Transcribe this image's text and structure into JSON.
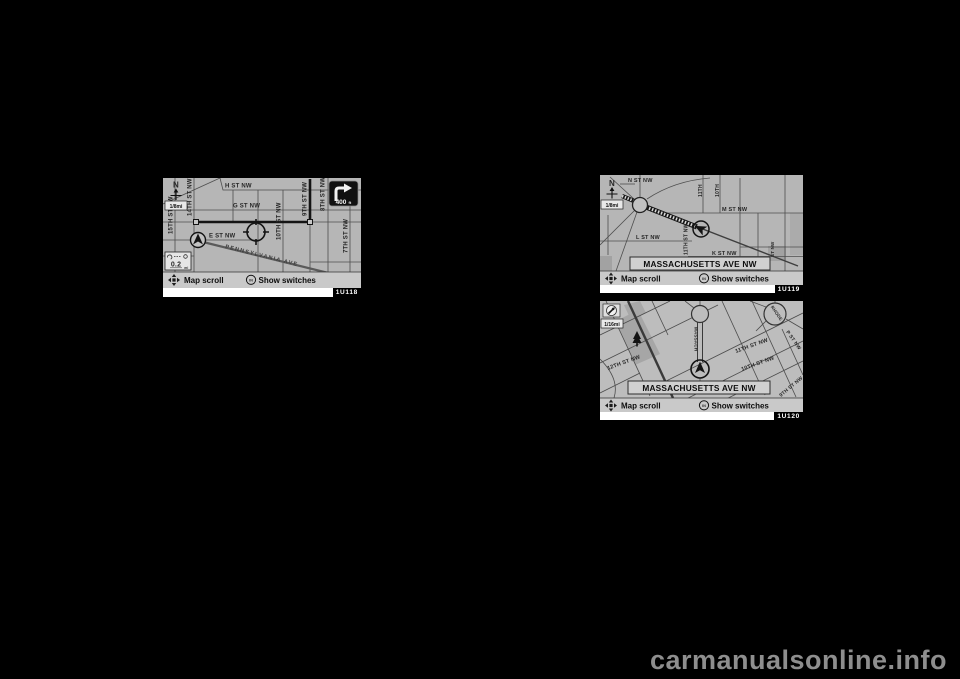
{
  "watermark": "carmanualsonline.info",
  "map1": {
    "figure_id": "1U118",
    "compass_n": "N",
    "scale_badge": "1/8mi",
    "turn": {
      "distance": "400",
      "unit": "ft"
    },
    "zoom_scale": {
      "value": "0.2",
      "unit": "mi"
    },
    "status": {
      "map_scroll": "Map scroll",
      "enter": "IN",
      "show_switches": "Show switches"
    },
    "streets": {
      "h": "H ST NW",
      "g": "G ST NW",
      "e": "E ST NW",
      "penn": "PENNSYLVANIA AVE",
      "s15": "15TH ST NW",
      "s14": "14TH ST NW",
      "s10": "10TH ST NW",
      "s9": "9TH ST NW",
      "s8": "8TH ST NW",
      "s7": "7TH ST NW"
    }
  },
  "map2": {
    "figure_id": "1U119",
    "compass_n": "N",
    "scale_badge": "1/8mi",
    "banner": "MASSACHUSETTS AVE NW",
    "status": {
      "map_scroll": "Map scroll",
      "enter": "IN",
      "show_switches": "Show switches"
    },
    "streets": {
      "n": "N ST NW",
      "m": "M ST NW",
      "l": "L ST NW",
      "k": "K ST NW",
      "s11": "11TH",
      "s10": "10TH",
      "s11full": "11TH ST NW",
      "edge": "ST NW"
    }
  },
  "map3": {
    "figure_id": "1U120",
    "scale_badge": "1/16mi",
    "banner": "MASSACHUSETTS AVE NW",
    "status": {
      "map_scroll": "Map scroll",
      "enter": "IN",
      "show_switches": "Show switches"
    },
    "streets": {
      "s12": "12TH ST NW",
      "s11": "11TH ST NW",
      "s10": "10TH ST NW",
      "s9": "9TH ST NW",
      "p": "P ST NW",
      "mass": "MASSACH",
      "rhode": "RHODE"
    }
  }
}
